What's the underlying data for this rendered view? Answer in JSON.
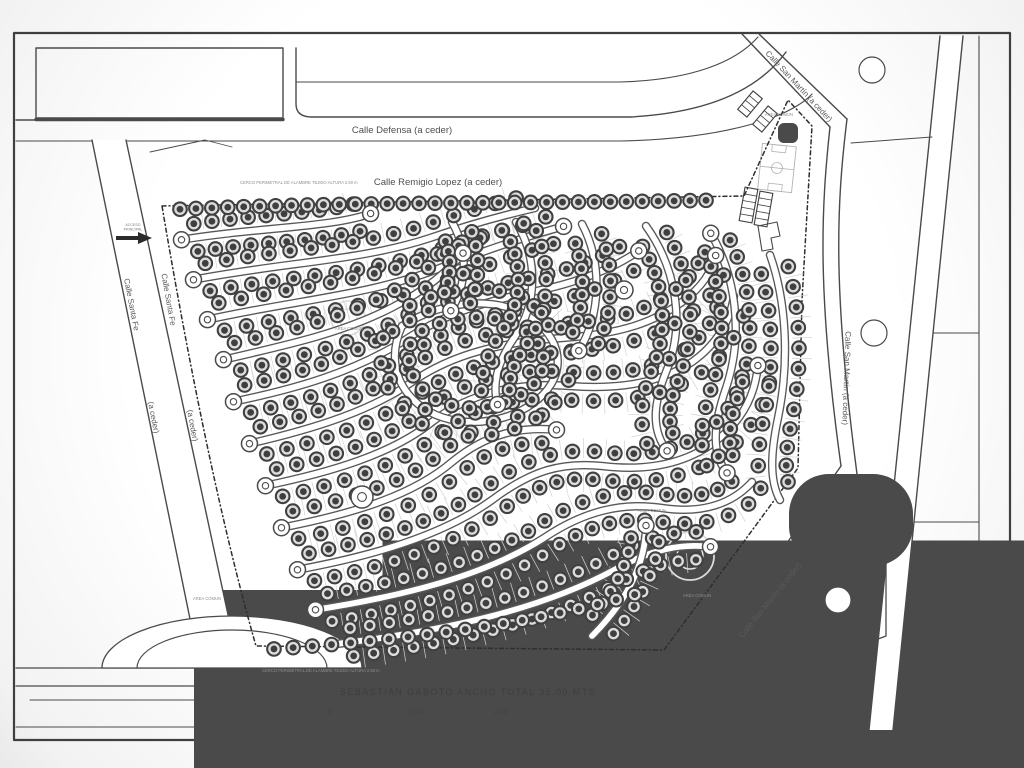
{
  "page": {
    "background": "#ffffff",
    "ink": "#4a4a4a"
  },
  "map": {
    "labels": {
      "defensa": "Calle Defensa (a ceder)",
      "remigio": "Calle Remigio Lopez (a ceder)",
      "san_martin": "Calle San Martín (a ceder)",
      "santa_fe_name": "Calle Santa Fe",
      "a_ceder": "(a ceder)",
      "gaboto": "SEBASTIAN  GABOTO   ANCHO TOTAL 35.00 MTS"
    },
    "scale_bar": {
      "ticks": [
        "0",
        "100",
        "200"
      ]
    },
    "annotations": {
      "fence_note": "CERCO PERIMETRAL DE ALAMBRE TEJIDO ALTURA 2.50 m",
      "area_comun": "AREA COMUN",
      "access_line1": "ACCESO",
      "access_line2": "PRINCIPAL"
    },
    "style": {
      "ink": "#4a4a4a",
      "road_dark": "#585858",
      "road_fill": "#ffffff",
      "lot_ring": "#404040",
      "lot_fill": "#dcdcdc",
      "lot_core": "#3f3f3f",
      "tick": "#d2d2d2",
      "perimeter": "#2e2e2e",
      "watermark": "#dadada"
    },
    "geometry": {
      "base": [
        {
          "t": "p",
          "d": "M14,33 H1010 V740 H14 Z",
          "w": 2.2,
          "c": "#3f3f3f"
        },
        {
          "t": "p",
          "d": "M979,36 V730",
          "w": 1.1
        },
        {
          "t": "p",
          "d": "M16,727 H1008",
          "w": 1.1
        },
        {
          "t": "p",
          "d": "M16,668 H978",
          "w": 1.2
        },
        {
          "t": "p",
          "d": "M16,686 H978",
          "w": 1.2
        },
        {
          "t": "p",
          "d": "M30,700 H243",
          "w": 1
        },
        {
          "t": "r",
          "x": 246,
          "y": 703,
          "w": 49,
          "h": 14
        },
        {
          "t": "r",
          "x": 307,
          "y": 703,
          "w": 226,
          "h": 14
        },
        {
          "t": "r",
          "x": 545,
          "y": 703,
          "w": 325,
          "h": 14
        },
        {
          "t": "r",
          "x": 900,
          "y": 703,
          "w": 78,
          "h": 14
        },
        {
          "t": "p",
          "d": "M345,703 V717",
          "w": 1
        },
        {
          "t": "p",
          "d": "M431,703 V717",
          "w": 1
        },
        {
          "t": "p",
          "d": "M517,703 V717",
          "w": 1
        },
        {
          "t": "p",
          "d": "M36,48 H283 V118 H36 Z",
          "w": 1.4
        },
        {
          "t": "p",
          "d": "M36,119.5 H283",
          "w": 3.4
        },
        {
          "t": "p",
          "d": "M296,48 L296,104 Q296,117 312,117 L630,117 C705,113 757,92 786,52",
          "w": 1.4
        },
        {
          "t": "p",
          "d": "M296,82 L620,82 C692,80 736,62 758,37",
          "w": 1.1
        },
        {
          "t": "p",
          "d": "M16,141 L620,141 C722,139 790,118 812,94",
          "w": 1.1
        },
        {
          "t": "p",
          "d": "M16,120 H36",
          "w": 1.4
        },
        {
          "t": "p",
          "d": "M150,152 L205,140 L232,147",
          "w": 0.9
        },
        {
          "t": "p",
          "d": "M742,34 L830,127",
          "w": 1.4
        },
        {
          "t": "p",
          "d": "M759,34 L847,119",
          "w": 1.4
        },
        {
          "t": "p",
          "d": "M830,127 C821,210 817,292 841,466",
          "w": 1.4
        },
        {
          "t": "p",
          "d": "M847,119 C836,208 833,292 857,474",
          "w": 1.4
        },
        {
          "t": "p",
          "d": "M841,466 L712,650",
          "w": 1.4
        },
        {
          "t": "p",
          "d": "M857,474 L740,672",
          "w": 1.4
        },
        {
          "t": "p",
          "d": "M940,36 L963,36 L893,730 L869,730 Z",
          "f": "#ffffff"
        },
        {
          "t": "p",
          "d": "M940,36 L869,730",
          "w": 1.4
        },
        {
          "t": "p",
          "d": "M963,36 L893,730",
          "w": 1.4
        },
        {
          "t": "p",
          "d": "M933,333 H979",
          "w": 1
        },
        {
          "t": "p",
          "d": "M914,522 H979",
          "w": 1
        },
        {
          "t": "p",
          "d": "M851,143 L932,137",
          "w": 1
        },
        {
          "t": "p",
          "d": "M92,140 L126,140 L236,652 L198,658 Z",
          "f": "#ffffff"
        },
        {
          "t": "p",
          "d": "M92,140 L198,658",
          "w": 1.4
        },
        {
          "t": "p",
          "d": "M126,140 L236,652",
          "w": 1.4
        },
        {
          "t": "p",
          "d": "M102,668 a130,52 0 0 1 260,0 Z",
          "f": "#ffffff",
          "w": 1.3
        },
        {
          "t": "p",
          "d": "M137,668 a95,38 0 0 1 190,0",
          "w": 1.2
        },
        {
          "t": "c",
          "x": 872,
          "y": 70,
          "r": 13
        },
        {
          "t": "c",
          "x": 874,
          "y": 333,
          "r": 13
        },
        {
          "t": "c",
          "x": 838,
          "y": 600,
          "r": 13
        },
        {
          "t": "p",
          "d": "M782,590 L838,546 L886,546 L886,636 L828,658 L786,638 Z",
          "w": 1.3
        },
        {
          "t": "r",
          "x": 820,
          "y": 505,
          "w": 62,
          "h": 30,
          "rx": 9
        },
        {
          "t": "hr",
          "x": 744,
          "y": 92,
          "w": 12,
          "h": 24,
          "rot": 40,
          "nl": 3
        },
        {
          "t": "hr",
          "x": 759,
          "y": 107,
          "w": 12,
          "h": 24,
          "rot": 40,
          "nl": 3
        },
        {
          "t": "r",
          "x": 783,
          "y": 128,
          "w": 10,
          "h": 10,
          "rx": 1
        },
        {
          "t": "field",
          "x": 760,
          "y": 145,
          "w": 34,
          "h": 46,
          "rot": 6
        },
        {
          "t": "hr",
          "x": 742,
          "y": 188,
          "w": 13,
          "h": 34,
          "rot": 10,
          "nl": 4
        },
        {
          "t": "hr",
          "x": 757,
          "y": 192,
          "w": 13,
          "h": 34,
          "rot": 10,
          "nl": 4
        },
        {
          "t": "p",
          "d": "M758,226 L777,222 L780,236 L771,238 L773,249 L762,251 Z",
          "w": 1.1
        },
        {
          "t": "p",
          "d": "M162,206 L744,196 L788,100 L812,126 L802,300 L798,468 L664,650 L256,646 C220,520 188,360 162,206 Z",
          "w": 1.5,
          "c": "#2e2e2e",
          "dash": "4 3 1 3"
        },
        {
          "t": "c",
          "x": 348,
          "y": 318,
          "r": 17,
          "c": "#d9d9d9",
          "w": 1.6,
          "f": "none"
        },
        {
          "t": "c",
          "x": 348,
          "y": 318,
          "r": 9,
          "c": "#e3e3e3",
          "w": 1.4,
          "f": "none"
        },
        {
          "t": "c",
          "x": 690,
          "y": 556,
          "r": 24,
          "c": "#dcdcdc",
          "w": 1.8,
          "f": "none"
        },
        {
          "t": "c",
          "x": 690,
          "y": 556,
          "r": 13,
          "c": "#e4e4e4",
          "w": 1.5,
          "f": "none"
        },
        {
          "t": "p",
          "d": "M116,236 H138 L138,232 L152,238 L138,244 L138,240 H116 Z",
          "f": "#2b2b2b"
        }
      ],
      "streets": [
        {
          "d": "M180,240 C258,227 332,228 372,213",
          "n": 10,
          "bs": 1,
          "be": 1
        },
        {
          "d": "M192,280 C285,262 360,261 430,238 C465,226 500,216 535,208",
          "n": 16,
          "bs": 1
        },
        {
          "d": "M206,320 C295,300 372,295 440,268 C478,253 520,238 565,226",
          "n": 16,
          "bs": 1,
          "be": 1
        },
        {
          "d": "M222,360 C292,344 345,332 393,307 C426,290 447,272 464,252",
          "n": 12,
          "bs": 1,
          "be": 1
        },
        {
          "d": "M232,402 C300,388 352,372 402,342 C442,315 482,302 532,292 C576,283 612,270 640,250",
          "n": 21,
          "bs": 1,
          "be": 1
        },
        {
          "d": "M248,444 C318,428 372,410 412,382 C452,354 502,342 562,338 C622,334 654,322 682,302 C702,287 712,272 716,254",
          "n": 25,
          "bs": 1,
          "be": 1
        },
        {
          "d": "M264,486 C332,472 392,454 432,422 C470,392 520,382 570,386 C622,390 662,382 692,362 C716,345 730,322 734,296",
          "n": 25,
          "bs": 1
        },
        {
          "d": "M280,528 C352,514 412,496 452,462 C486,434 520,426 558,430",
          "n": 13,
          "bs": 1,
          "be": 1
        },
        {
          "d": "M296,570 C372,556 442,536 492,500 C532,470 562,462 602,466 C652,472 692,462 722,436 C746,415 756,390 758,364",
          "n": 26,
          "bs": 1,
          "be": 1
        },
        {
          "d": "M314,610 C404,596 484,576 544,538 C584,511 622,502 662,508 C702,514 732,504 752,482",
          "n": 23,
          "bs": 1
        },
        {
          "d": "M336,644 C436,632 536,612 614,570 C652,549 682,543 712,547",
          "n": 19,
          "be": 1
        },
        {
          "d": "M402,326 C446,298 502,296 534,320 C566,344 566,380 532,404 C498,428 446,428 418,404 C392,382 390,352 402,326 Z",
          "n": 21
        },
        {
          "d": "M452,222 C468,250 468,284 450,312",
          "n": 6,
          "be": 1
        },
        {
          "d": "M516,222 C538,258 538,304 514,338 C496,364 492,386 498,406",
          "n": 12,
          "be": 1
        },
        {
          "d": "M582,224 C602,262 602,314 578,352",
          "n": 8,
          "be": 1
        },
        {
          "d": "M646,226 C676,268 686,324 666,372 C652,407 652,432 668,452",
          "n": 14,
          "be": 1
        },
        {
          "d": "M710,232 C736,276 744,334 726,388 C712,428 712,456 728,474",
          "n": 14,
          "bs": 1,
          "be": 1
        },
        {
          "d": "M770,255 C786,300 790,360 778,418 C770,456 770,482 780,500",
          "n": 12
        },
        {
          "d": "M592,636 C628,600 646,562 646,524",
          "n": 7,
          "be": 1
        },
        {
          "d": "M164,210 C340,201 540,204 722,200",
          "n": 34,
          "road": 0,
          "sides": [
            0
          ]
        },
        {
          "d": "M258,650 C400,641 540,624 650,590",
          "n": 20,
          "road": 0,
          "sides": [
            0
          ]
        }
      ],
      "hubs": [
        {
          "x": 362,
          "y": 497,
          "r": 11
        },
        {
          "x": 624,
          "y": 290,
          "r": 9
        }
      ]
    }
  }
}
